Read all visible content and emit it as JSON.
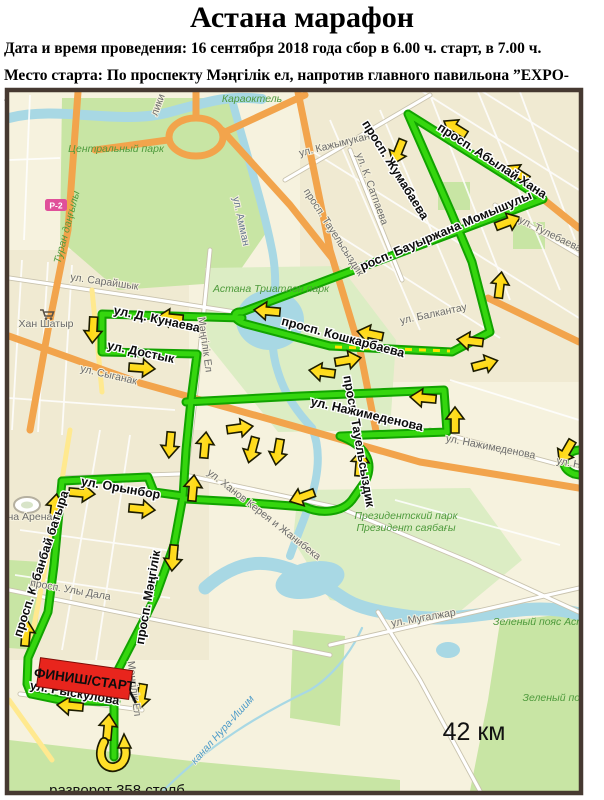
{
  "header": {
    "title": "Астана марафон",
    "line1": "Дата и время проведения: 16 сентября 2018 года сбор в 6.00 ч. старт, в 7.00 ч.",
    "line2": "Место старта: По проспекту Мәңгілік ел, напротив главного павильона ”EXPO-2017”"
  },
  "map": {
    "finish_label": "ФИНИШ/СТАРТ",
    "distance_label": "42 км",
    "turnaround_label": "разворот 358 столб",
    "road_badge": "Р-2",
    "colors": {
      "route": "#35d60e",
      "route_casing": "#12a300",
      "arrow": "#ffe11a",
      "finish_bg": "#e8251d",
      "water": "#a8d8e4",
      "park": "#c8e5a4",
      "road_orange": "#f2a44c",
      "road_yellow": "#ffe98f",
      "frame": "#463931",
      "background": "#f6f2de"
    },
    "labels": {
      "karaotkel": "Караоктель",
      "central_park": "Центральный парк",
      "turan": "Туран даңғылы",
      "liki": "лики",
      "amman": "ул. Амман",
      "kazhymukana": "ул. Кажымукана",
      "satpaeva": "ул. К. Сатпаева",
      "abylai": "просп. Абылай Хана",
      "zhumabaeva": "просп. Жумабаева",
      "momyshuly": "просп. Бауыржана Момышулы",
      "tulebaeva": "ул. Тулебаева",
      "tauelsyzdyk_gray": "просп. Тауельсыздик",
      "saraishyk": "ул. Сарайшык",
      "triatlon": "Астана Триатлон парк",
      "balkantau": "ул. Балкантау",
      "kunaeva": "ул. Д. Кунаева",
      "dostyk": "ул. Достык",
      "koshkarbaeva": "просп. Кошкарбаева",
      "syganak": "ул. Сыганак",
      "khan_shatyr": "Хан Шатыр",
      "mangilik_el_road": "Мәңгілік Ел",
      "tauelsyzdyk_black": "просп. Тауельсыздик",
      "nazhimedenova_black": "ул. Нажимеденова",
      "nazhimedenova_gray": "ул. Нажимеденова",
      "nazhimedenova_gray2": "ул. Н",
      "khanov": "ул. Ханов Керея и Жанибека",
      "president_park": "Президентский парк",
      "president_park_kz": "Президент саябағы",
      "orynbor": "ул. Орынбор",
      "kabanbai": "просп. Кабанбай батыра",
      "uly_dala": "просп. Улы Дала",
      "mangilik": "просп. Мәңгілік",
      "astana_arena": "стана Арена",
      "mugalzhar": "ул. Мугалжар",
      "green_belt1": "Зеленый пояс Аст",
      "green_belt2": "Зеленый поя",
      "canal": "канал Нура-Ишим",
      "ryskulova": "ул. Рыскулова"
    }
  }
}
